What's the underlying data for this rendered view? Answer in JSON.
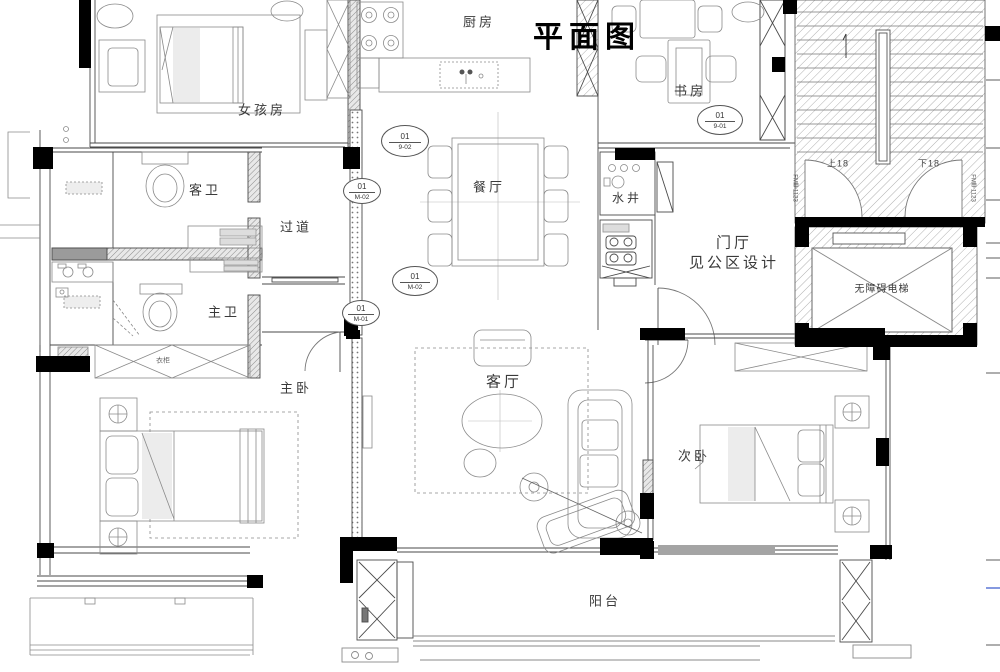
{
  "title": "平面图",
  "rooms": {
    "girl_room": "女孩房",
    "kitchen": "厨房",
    "study": "书房",
    "guest_bath": "客卫",
    "hallway": "过道",
    "dining": "餐厅",
    "water_shaft": "水井",
    "foyer": "门厅",
    "foyer_note": "见公区设计",
    "elevator": "无障碍电梯",
    "master_bath": "主卫",
    "master_bedroom": "主卧",
    "living_room": "客厅",
    "second_bedroom": "次卧",
    "balcony": "阳台",
    "wardrobe": "衣柜"
  },
  "stairs": {
    "up_label": "上18",
    "down_label": "下18",
    "left_door_code": "FM甲1123",
    "right_door_code": "FM甲1123"
  },
  "markers": [
    {
      "no": "01",
      "ref": "9-02"
    },
    {
      "no": "01",
      "ref": "M-02"
    },
    {
      "no": "01",
      "ref": "M-02"
    },
    {
      "no": "01",
      "ref": "M-01"
    },
    {
      "no": "01",
      "ref": "9-01"
    }
  ],
  "colors": {
    "wall": "#000000",
    "line": "#4a4a4a",
    "hatch": "#b0b0b0",
    "paper": "#ffffff"
  }
}
